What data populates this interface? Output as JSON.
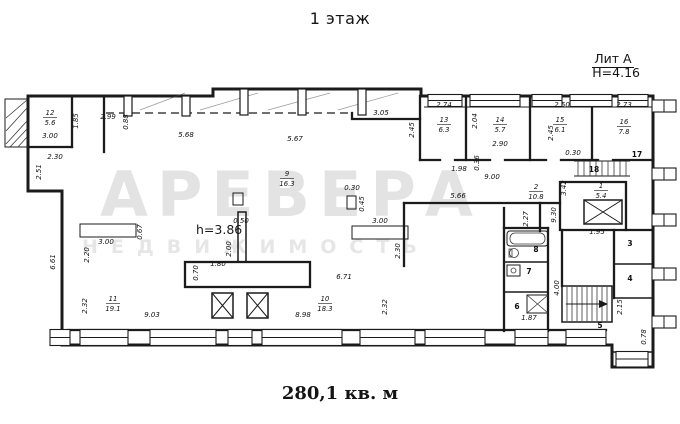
{
  "header": {
    "title": "1 этаж"
  },
  "litera": {
    "name": "Лит А",
    "height": "Н=4.16"
  },
  "footer": {
    "total_area": "280,1 кв. м"
  },
  "watermark": {
    "line1": "АРЕВЕРА",
    "line2": "НЕДВИЖИМОСТЬ"
  },
  "plan": {
    "height_note": "h=3.86",
    "room_labels": [
      {
        "num": "12",
        "area": "5.6",
        "x": 50,
        "y": 117
      },
      {
        "num": "9",
        "area": "16.3",
        "x": 287,
        "y": 178
      },
      {
        "num": "11",
        "area": "19.1",
        "x": 113,
        "y": 303
      },
      {
        "num": "10",
        "area": "18.3",
        "x": 325,
        "y": 303
      },
      {
        "num": "13",
        "area": "6.3",
        "x": 444,
        "y": 124
      },
      {
        "num": "14",
        "area": "5.7",
        "x": 500,
        "y": 124
      },
      {
        "num": "15",
        "area": "6.1",
        "x": 560,
        "y": 124
      },
      {
        "num": "16",
        "area": "7.8",
        "x": 624,
        "y": 126
      },
      {
        "num": "2",
        "area": "10.8",
        "x": 536,
        "y": 191
      },
      {
        "num": "1",
        "area": "5.4",
        "x": 601,
        "y": 190
      }
    ],
    "room_numbers": [
      {
        "num": "17",
        "x": 637,
        "y": 157
      },
      {
        "num": "18",
        "x": 594,
        "y": 172
      },
      {
        "num": "3",
        "x": 630,
        "y": 246
      },
      {
        "num": "4",
        "x": 630,
        "y": 281
      },
      {
        "num": "5",
        "x": 600,
        "y": 328
      },
      {
        "num": "6",
        "x": 517,
        "y": 309
      },
      {
        "num": "7",
        "x": 529,
        "y": 274
      },
      {
        "num": "8",
        "x": 536,
        "y": 252
      }
    ],
    "dim_labels": [
      {
        "t": "3.00",
        "x": 50,
        "y": 138,
        "r": 0
      },
      {
        "t": "1.85",
        "x": 78,
        "y": 121,
        "r": -90
      },
      {
        "t": "2.99",
        "x": 108,
        "y": 119,
        "r": 0
      },
      {
        "t": "0.88",
        "x": 128,
        "y": 122,
        "r": -90
      },
      {
        "t": "5.68",
        "x": 186,
        "y": 137,
        "r": 0
      },
      {
        "t": "5.67",
        "x": 295,
        "y": 141,
        "r": 0
      },
      {
        "t": "3.05",
        "x": 381,
        "y": 115,
        "r": 0
      },
      {
        "t": "2.30",
        "x": 55,
        "y": 159,
        "r": 0
      },
      {
        "t": "2.51",
        "x": 41,
        "y": 172,
        "r": -90
      },
      {
        "t": "6.61",
        "x": 55,
        "y": 262,
        "r": -90
      },
      {
        "t": "2.45",
        "x": 414,
        "y": 130,
        "r": -90
      },
      {
        "t": "2.74",
        "x": 444,
        "y": 107,
        "r": 0
      },
      {
        "t": "2.04",
        "x": 477,
        "y": 121,
        "r": -90
      },
      {
        "t": "2.90",
        "x": 500,
        "y": 146,
        "r": 0
      },
      {
        "t": "2.50",
        "x": 562,
        "y": 107,
        "r": 0
      },
      {
        "t": "2.45",
        "x": 553,
        "y": 133,
        "r": -90
      },
      {
        "t": "2.73",
        "x": 624,
        "y": 107,
        "r": 0
      },
      {
        "t": "1.98",
        "x": 459,
        "y": 171,
        "r": 0
      },
      {
        "t": "0.36",
        "x": 479,
        "y": 163,
        "r": -90
      },
      {
        "t": "9.00",
        "x": 492,
        "y": 179,
        "r": 0
      },
      {
        "t": "0.30",
        "x": 573,
        "y": 155,
        "r": 0
      },
      {
        "t": "0.30",
        "x": 352,
        "y": 190,
        "r": 0
      },
      {
        "t": "0.45",
        "x": 364,
        "y": 204,
        "r": -90
      },
      {
        "t": "5.66",
        "x": 458,
        "y": 198,
        "r": 0
      },
      {
        "t": "2.30",
        "x": 400,
        "y": 251,
        "r": -90
      },
      {
        "t": "3.00",
        "x": 380,
        "y": 223,
        "r": 0
      },
      {
        "t": "3.00",
        "x": 106,
        "y": 244,
        "r": 0
      },
      {
        "t": "0.67",
        "x": 142,
        "y": 232,
        "r": -90
      },
      {
        "t": "2.20",
        "x": 89,
        "y": 255,
        "r": -90
      },
      {
        "t": "0.50",
        "x": 241,
        "y": 223,
        "r": 0
      },
      {
        "t": "2.00",
        "x": 231,
        "y": 249,
        "r": -90
      },
      {
        "t": "1.80",
        "x": 218,
        "y": 266,
        "r": 0
      },
      {
        "t": "0.70",
        "x": 198,
        "y": 273,
        "r": -90
      },
      {
        "t": "6.71",
        "x": 344,
        "y": 279,
        "r": 0
      },
      {
        "t": "2.32",
        "x": 87,
        "y": 306,
        "r": -90
      },
      {
        "t": "2.32",
        "x": 387,
        "y": 307,
        "r": -90
      },
      {
        "t": "9.03",
        "x": 152,
        "y": 317,
        "r": 0
      },
      {
        "t": "8.98",
        "x": 303,
        "y": 317,
        "r": 0
      },
      {
        "t": "3.42",
        "x": 566,
        "y": 188,
        "r": -90
      },
      {
        "t": "9.30",
        "x": 556,
        "y": 215,
        "r": -90
      },
      {
        "t": "2.27",
        "x": 528,
        "y": 219,
        "r": -90
      },
      {
        "t": "1.95",
        "x": 597,
        "y": 234,
        "r": 0
      },
      {
        "t": "1.87",
        "x": 529,
        "y": 320,
        "r": 0
      },
      {
        "t": "4.00",
        "x": 559,
        "y": 288,
        "r": -90
      },
      {
        "t": "2.15",
        "x": 622,
        "y": 307,
        "r": -90
      },
      {
        "t": "0.78",
        "x": 646,
        "y": 337,
        "r": -90
      }
    ]
  }
}
